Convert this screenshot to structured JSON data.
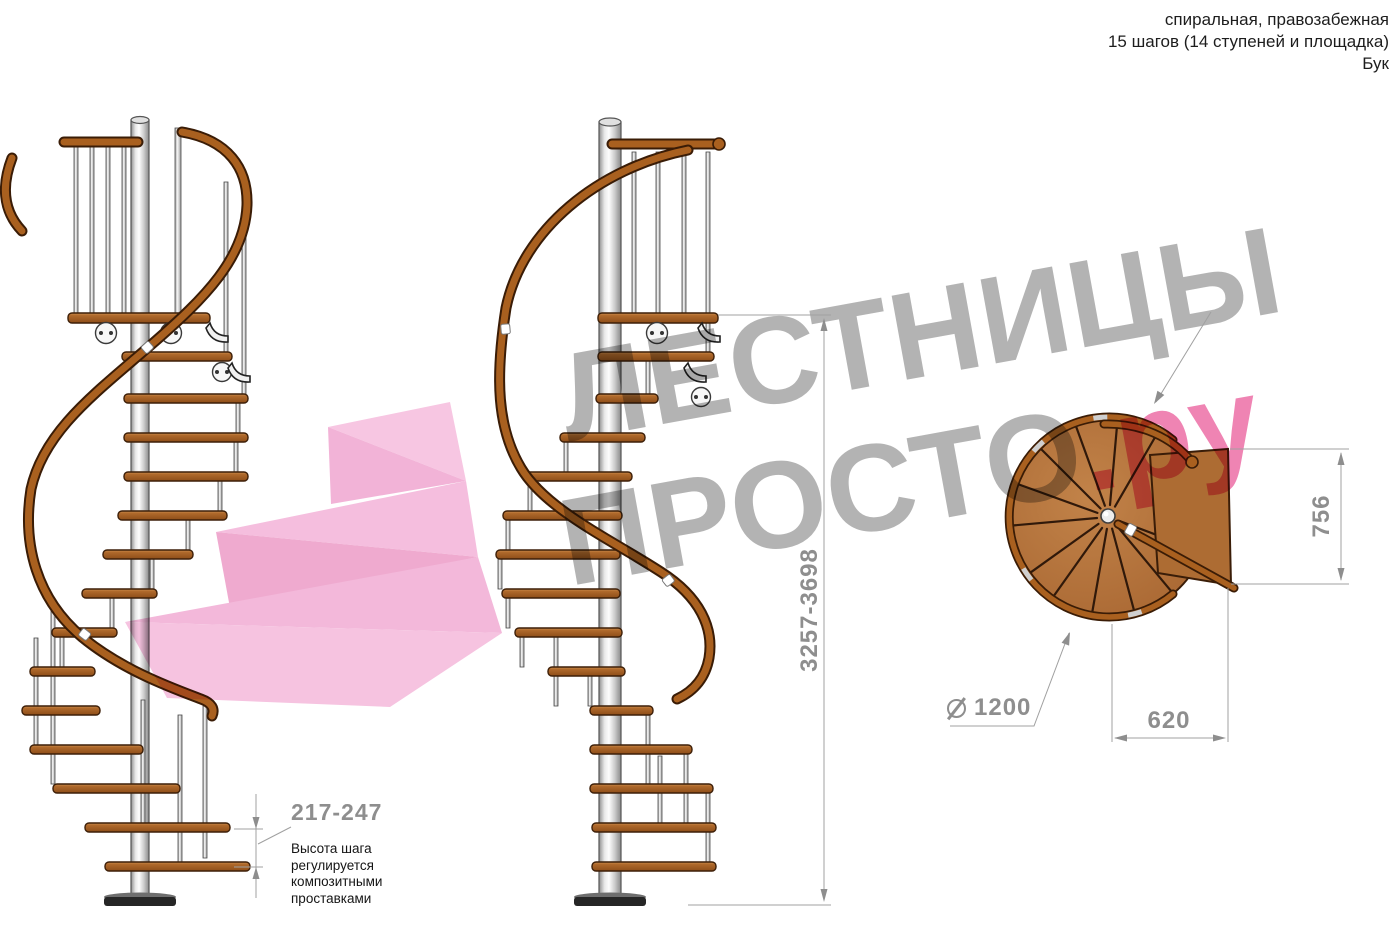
{
  "header": {
    "type_line": "спиральная, правозабежная",
    "steps_line": "15 шагов (14 ступеней и площадка)",
    "material_line": "Бук"
  },
  "watermark": {
    "word1": "ЛЕСТНИЦЫ",
    "word2": "ПРОСТО",
    "domain_suffix": ".ру"
  },
  "dimensions": {
    "total_height": "3257-3698",
    "step_height_range": "217-247",
    "landing_depth": "756",
    "tread_width": "620",
    "diameter_value": "1200",
    "note_line1": "Высота шага",
    "note_line2": "регулируется",
    "note_line3": "композитными",
    "note_line4": "проставками"
  },
  "colors": {
    "wood": "#a96327",
    "wood_dark": "#3d1f08",
    "rail": "#a9601f",
    "dim_gray": "#8e8e8e",
    "watermark_gray": "#a6a6a6",
    "watermark_pink": "#ec6ea6",
    "arrow_pink": "#f2b3d7",
    "pole_gray": "#c9c9c9"
  }
}
